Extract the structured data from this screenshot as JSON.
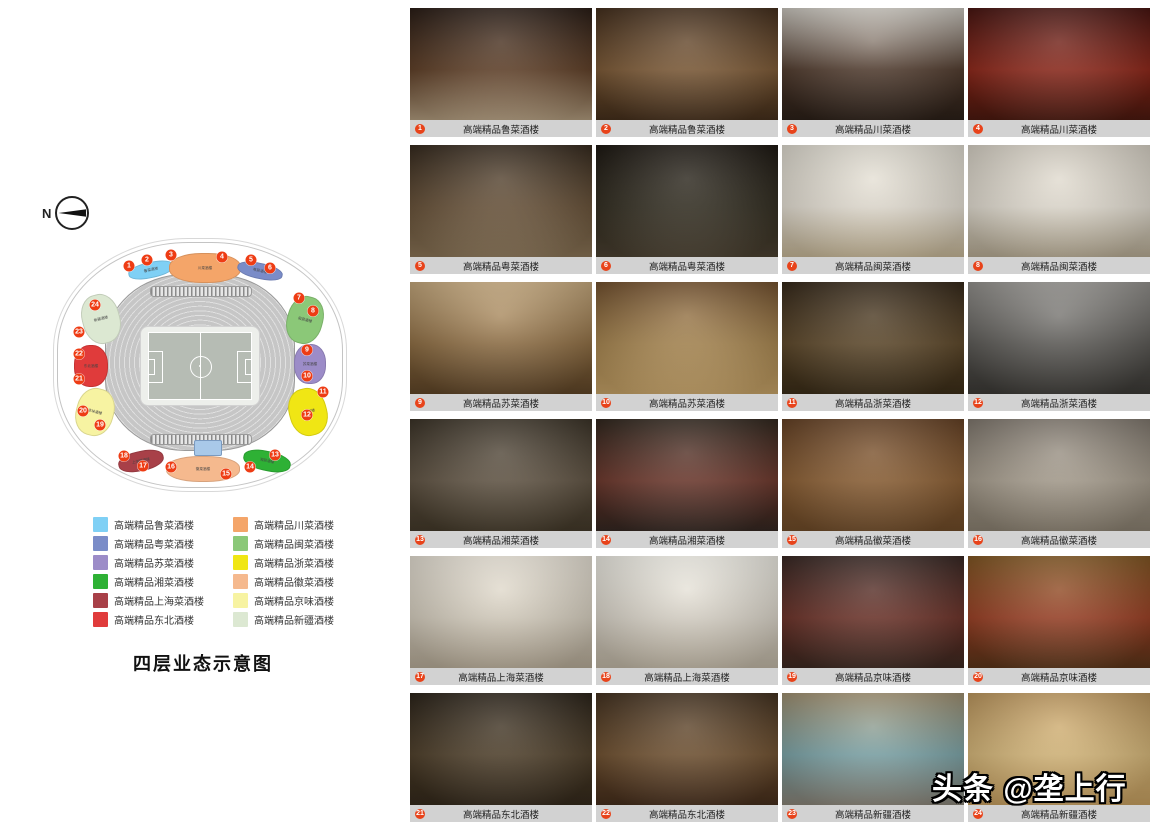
{
  "compass": {
    "label": "N"
  },
  "floorplan": {
    "title": "四层业态示意图",
    "legend": {
      "columns": [
        [
          {
            "label": "高端精品鲁菜酒楼",
            "color": "#7fd0f5"
          },
          {
            "label": "高端精品粤菜酒楼",
            "color": "#7a8cc8"
          },
          {
            "label": "高端精品苏菜酒楼",
            "color": "#9c8cc8"
          },
          {
            "label": "高端精品湘菜酒楼",
            "color": "#2eb135"
          },
          {
            "label": "高端精品上海菜酒楼",
            "color": "#a84048"
          },
          {
            "label": "高端精品东北酒楼",
            "color": "#e03b3b"
          }
        ],
        [
          {
            "label": "高端精品川菜酒楼",
            "color": "#f4a569"
          },
          {
            "label": "高端精品闽菜酒楼",
            "color": "#8bc878"
          },
          {
            "label": "高端精品浙菜酒楼",
            "color": "#f0e614"
          },
          {
            "label": "高端精品徽菜酒楼",
            "color": "#f5b98e"
          },
          {
            "label": "高端精品京味酒楼",
            "color": "#f7f3a2"
          },
          {
            "label": "高端精品新疆酒楼",
            "color": "#dce8d2"
          }
        ]
      ]
    },
    "stadium": {
      "zones": [
        {
          "label": "鲁菜酒楼",
          "color": "#7fd0f5",
          "x": 96,
          "y": 30,
          "w": 46,
          "h": 16,
          "r": -12
        },
        {
          "label": "川菜酒楼",
          "color": "#f4a569",
          "x": 150,
          "y": 28,
          "w": 72,
          "h": 30,
          "r": 0
        },
        {
          "label": "粤菜酒楼",
          "color": "#7a8cc8",
          "x": 205,
          "y": 31,
          "w": 46,
          "h": 16,
          "r": 12
        },
        {
          "label": "闽菜酒楼",
          "color": "#8bc878",
          "x": 250,
          "y": 80,
          "w": 36,
          "h": 48,
          "r": 15
        },
        {
          "label": "苏菜酒楼",
          "color": "#9c8cc8",
          "x": 255,
          "y": 124,
          "w": 32,
          "h": 40,
          "r": 0
        },
        {
          "label": "浙菜酒楼",
          "color": "#f0e614",
          "x": 253,
          "y": 172,
          "w": 38,
          "h": 48,
          "r": -15
        },
        {
          "label": "湘菜酒楼",
          "color": "#2eb135",
          "x": 212,
          "y": 221,
          "w": 48,
          "h": 20,
          "r": 12
        },
        {
          "label": "徽菜酒楼",
          "color": "#f5b98e",
          "x": 148,
          "y": 229,
          "w": 74,
          "h": 26,
          "r": 0
        },
        {
          "label": "上海菜酒楼",
          "color": "#a84048",
          "x": 86,
          "y": 221,
          "w": 46,
          "h": 20,
          "r": -12
        },
        {
          "label": "京味酒楼",
          "color": "#f7f3a2",
          "x": 40,
          "y": 172,
          "w": 38,
          "h": 48,
          "r": 15
        },
        {
          "label": "东北酒楼",
          "color": "#e03b3b",
          "x": 36,
          "y": 126,
          "w": 34,
          "h": 42,
          "r": 0
        },
        {
          "label": "新疆酒楼",
          "color": "#dce8d2",
          "x": 46,
          "y": 79,
          "w": 38,
          "h": 50,
          "r": -15
        }
      ],
      "markers": [
        {
          "n": "1",
          "x": 74,
          "y": 26
        },
        {
          "n": "2",
          "x": 92,
          "y": 20
        },
        {
          "n": "3",
          "x": 116,
          "y": 15
        },
        {
          "n": "4",
          "x": 167,
          "y": 17
        },
        {
          "n": "5",
          "x": 196,
          "y": 20
        },
        {
          "n": "6",
          "x": 215,
          "y": 28
        },
        {
          "n": "7",
          "x": 244,
          "y": 58
        },
        {
          "n": "8",
          "x": 258,
          "y": 71
        },
        {
          "n": "9",
          "x": 252,
          "y": 110
        },
        {
          "n": "10",
          "x": 252,
          "y": 136
        },
        {
          "n": "11",
          "x": 268,
          "y": 152
        },
        {
          "n": "12",
          "x": 252,
          "y": 175
        },
        {
          "n": "13",
          "x": 220,
          "y": 215
        },
        {
          "n": "14",
          "x": 195,
          "y": 227
        },
        {
          "n": "15",
          "x": 171,
          "y": 234
        },
        {
          "n": "16",
          "x": 116,
          "y": 227
        },
        {
          "n": "17",
          "x": 88,
          "y": 226
        },
        {
          "n": "18",
          "x": 69,
          "y": 216
        },
        {
          "n": "19",
          "x": 45,
          "y": 185
        },
        {
          "n": "20",
          "x": 28,
          "y": 171
        },
        {
          "n": "21",
          "x": 24,
          "y": 139
        },
        {
          "n": "22",
          "x": 24,
          "y": 114
        },
        {
          "n": "23",
          "x": 24,
          "y": 92
        },
        {
          "n": "24",
          "x": 40,
          "y": 65
        }
      ]
    }
  },
  "gallery": {
    "items": [
      {
        "num": "1",
        "caption": "高端精品鲁菜酒楼",
        "colors": [
          "#241710",
          "#5e3d24",
          "#b49e80"
        ]
      },
      {
        "num": "2",
        "caption": "高端精品鲁菜酒楼",
        "colors": [
          "#3e2917",
          "#7c5833",
          "#46301c"
        ]
      },
      {
        "num": "3",
        "caption": "高端精品川菜酒楼",
        "colors": [
          "#c9c5bd",
          "#503a2c",
          "#2c2018"
        ]
      },
      {
        "num": "4",
        "caption": "高端精品川菜酒楼",
        "colors": [
          "#420f0b",
          "#8e2416",
          "#4c1a10"
        ]
      },
      {
        "num": "5",
        "caption": "高端精品粤菜酒楼",
        "colors": [
          "#302418",
          "#685137",
          "#8c7658"
        ]
      },
      {
        "num": "6",
        "caption": "高端精品粤菜酒楼",
        "colors": [
          "#17120c",
          "#302b1e",
          "#4c4232"
        ]
      },
      {
        "num": "7",
        "caption": "高端精品闽菜酒楼",
        "colors": [
          "#dedacf",
          "#e9e3d7",
          "#c9b999"
        ]
      },
      {
        "num": "8",
        "caption": "高端精品闽菜酒楼",
        "colors": [
          "#d6d0c4",
          "#e7e1d5",
          "#baae96"
        ]
      },
      {
        "num": "9",
        "caption": "高端精品苏菜酒楼",
        "colors": [
          "#c3a67a",
          "#906e42",
          "#604628"
        ]
      },
      {
        "num": "10",
        "caption": "高端精品苏菜酒楼",
        "colors": [
          "#6e4c29",
          "#aa874f",
          "#caa66a"
        ]
      },
      {
        "num": "11",
        "caption": "高端精品浙菜酒楼",
        "colors": [
          "#302314",
          "#5c4627",
          "#3c2e19"
        ]
      },
      {
        "num": "12",
        "caption": "高端精品浙菜酒楼",
        "colors": [
          "#908e8a",
          "#5c5a56",
          "#3c3a36"
        ]
      },
      {
        "num": "13",
        "caption": "高端精品湘菜酒楼",
        "colors": [
          "#362e22",
          "#605342",
          "#443a2a"
        ]
      },
      {
        "num": "14",
        "caption": "高端精品湘菜酒楼",
        "colors": [
          "#2b2118",
          "#6c3529",
          "#352822"
        ]
      },
      {
        "num": "15",
        "caption": "高端精品徽菜酒楼",
        "colors": [
          "#603c1f",
          "#8c5e31",
          "#704c29"
        ]
      },
      {
        "num": "16",
        "caption": "高端精品徽菜酒楼",
        "colors": [
          "#7c746a",
          "#aaa090",
          "#8c8272"
        ]
      },
      {
        "num": "17",
        "caption": "高端精品上海菜酒楼",
        "colors": [
          "#e5dfd3",
          "#dad2c2",
          "#baae9a"
        ]
      },
      {
        "num": "18",
        "caption": "高端精品上海菜酒楼",
        "colors": [
          "#edebe3",
          "#ded8cc",
          "#c4baa8"
        ]
      },
      {
        "num": "19",
        "caption": "高端精品京味酒楼",
        "colors": [
          "#32221e",
          "#6c3026",
          "#3e2a22"
        ]
      },
      {
        "num": "20",
        "caption": "高端精品京味酒楼",
        "colors": [
          "#7c521e",
          "#9c3e22",
          "#5c361a"
        ]
      },
      {
        "num": "21",
        "caption": "高端精品东北酒楼",
        "colors": [
          "#261e14",
          "#4e3e28",
          "#352a1c"
        ]
      },
      {
        "num": "22",
        "caption": "高端精品东北酒楼",
        "colors": [
          "#3e2c1a",
          "#70502e",
          "#472f1d"
        ]
      },
      {
        "num": "23",
        "caption": "高端精品新疆酒楼",
        "colors": [
          "#9c8c6c",
          "#7ca6aa",
          "#8c867a"
        ]
      },
      {
        "num": "24",
        "caption": "高端精品新疆酒楼",
        "colors": [
          "#ba945a",
          "#daba7a",
          "#caa262"
        ]
      }
    ]
  },
  "watermark": {
    "text": "头条 @垄上行"
  }
}
